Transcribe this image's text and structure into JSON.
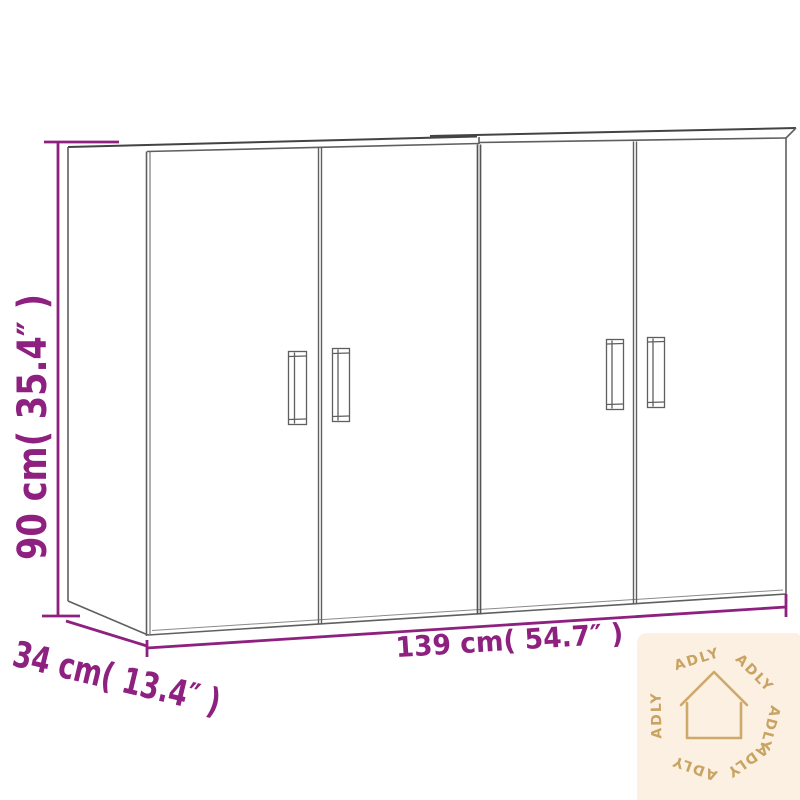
{
  "meta": {
    "background": "#ffffff",
    "accent_color": "#8e2080",
    "line_color": "#5f5f5f",
    "watermark_bg": "#fbf0e2",
    "watermark_fg": "#c9a361"
  },
  "diagram": {
    "kind": "product-dimension-line-drawing",
    "object": "two wall cabinets with four doors and vertical handles"
  },
  "dimensions": {
    "height": {
      "text": "90 cm( 35.4″ )",
      "cm": "90",
      "inches": "35.4"
    },
    "depth": {
      "text": "34 cm( 13.4″ )",
      "cm": "34",
      "inches": "13.4"
    },
    "width": {
      "text": "139 cm( 54.7″ )",
      "cm": "139",
      "inches": "54.7"
    }
  },
  "watermark": {
    "brand": "ADLY",
    "icon": "house-outline-icon",
    "ring": [
      "ADLY",
      "ADLY",
      "ADLY",
      "ADLY",
      "ADLY",
      "ADLY"
    ]
  }
}
